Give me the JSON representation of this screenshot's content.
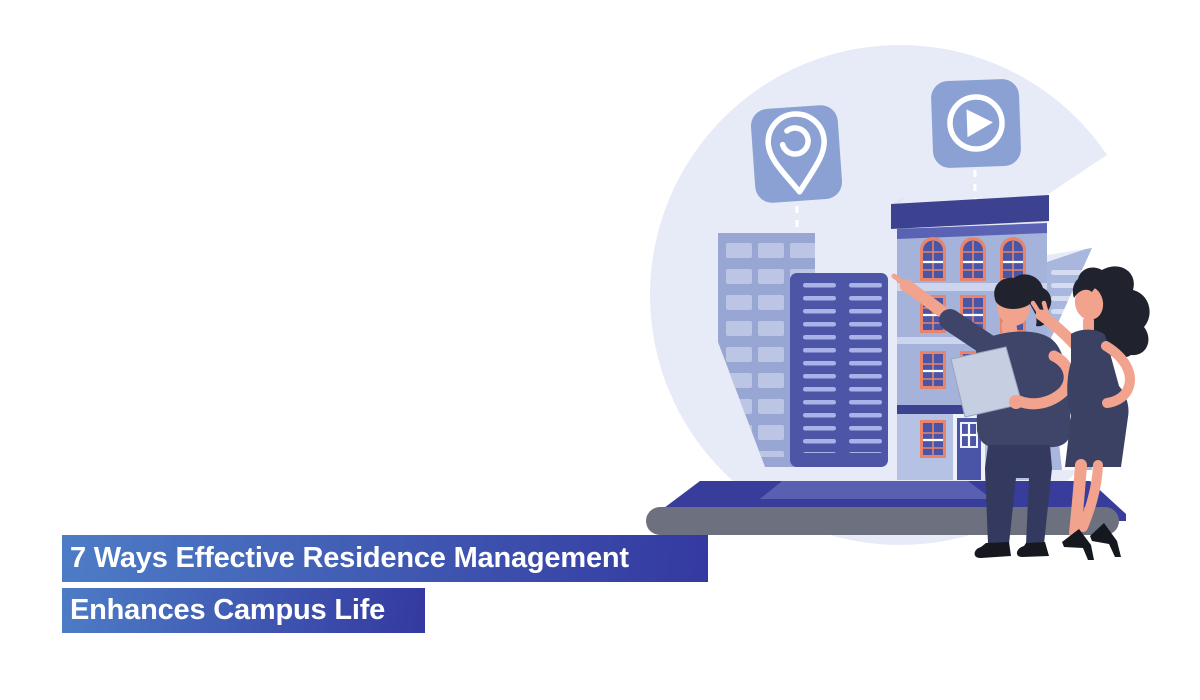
{
  "title": {
    "line1": "7 Ways Effective Residence Management",
    "line2": "Enhances Campus Life"
  },
  "icons": {
    "location": "location-pin-icon",
    "play": "play-icon"
  },
  "palette": {
    "banner_start": "#4d7cc6",
    "banner_end": "#3439a0",
    "title_text": "#ffffff",
    "circle_bg": "#e7ebf7",
    "badge": "#8ba1d4",
    "icon_white": "#ffffff",
    "dash_white": "#ffffff",
    "back_building": "#98a6d3",
    "back_window": "#bcc5e4",
    "front_building": "#4d55a7",
    "front_slat": "#a9b3e8",
    "right_building": "#a9b6dd",
    "right_slat": "#d5dcf0",
    "main_facade": "#a5b2da",
    "main_ground": "#b6c2e3",
    "cornice": "#3c4290",
    "band_mid": "#5a62b3",
    "band_light": "#ccd4ee",
    "window_frame": "#e8846c",
    "window_glass": "#4a55a8",
    "laptop_top": "#383d9b",
    "laptop_inner": "#5f65b5",
    "laptop_base": "#6d717f",
    "skin": "#f2a38d",
    "hair": "#20222e",
    "shirt": "#3f4569",
    "pants": "#343a5f",
    "dress": "#3a4163",
    "black": "#16181f",
    "tablet": "#c6cee2"
  }
}
